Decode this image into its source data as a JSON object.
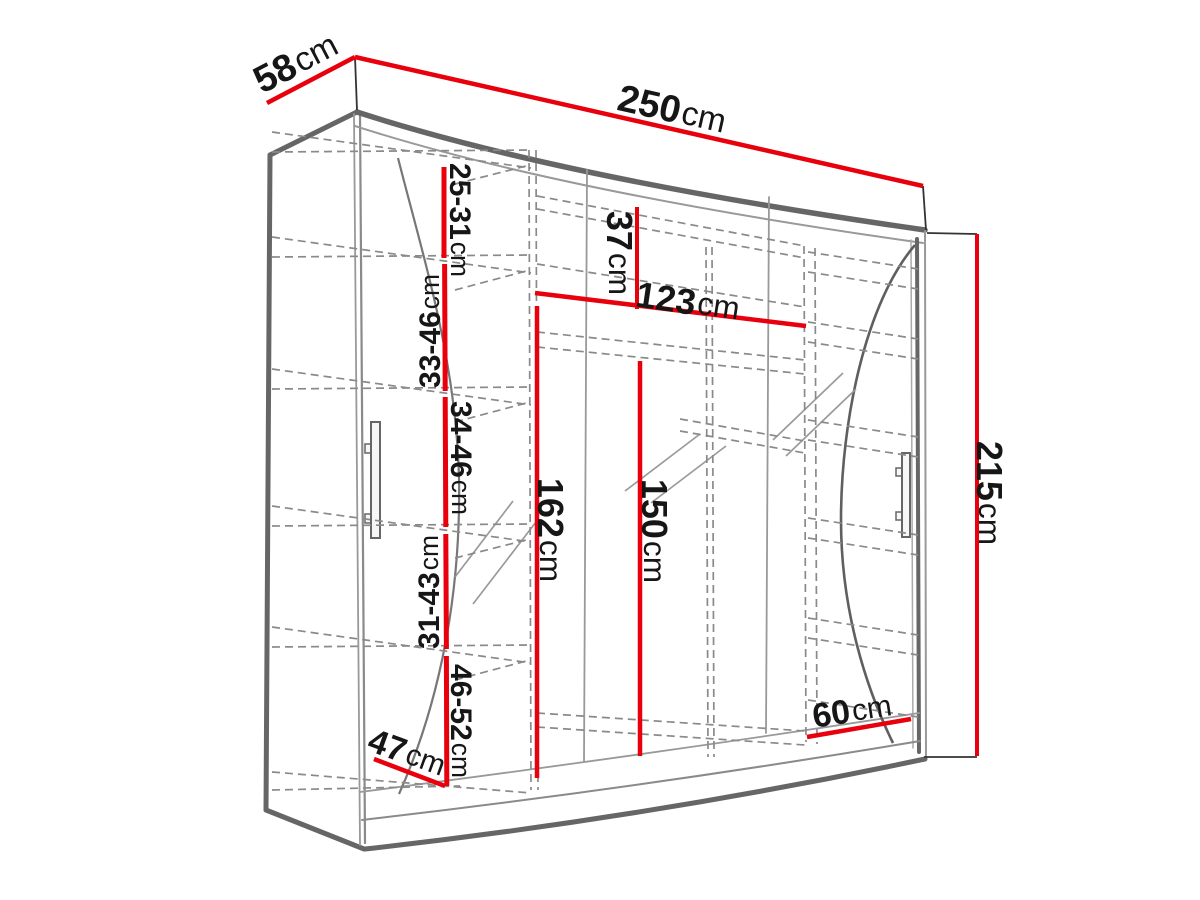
{
  "diagram": {
    "type": "furniture-dimension-drawing",
    "subject": "three-door sliding wardrobe with interior shelves",
    "accent_color": "#e8000d",
    "structure_color": "#666666",
    "dimensions": {
      "depth": {
        "value": "58",
        "unit": "cm"
      },
      "width": {
        "value": "250",
        "unit": "cm"
      },
      "height": {
        "value": "215",
        "unit": "cm"
      },
      "top_compartment_height": {
        "value": "37",
        "unit": "cm"
      },
      "middle_compartment_width": {
        "value": "123",
        "unit": "cm"
      },
      "hanging_height_left": {
        "value": "162",
        "unit": "cm"
      },
      "hanging_height_right": {
        "value": "150",
        "unit": "cm"
      },
      "right_compartment_width": {
        "value": "60",
        "unit": "cm"
      },
      "interior_depth": {
        "value": "47",
        "unit": "cm"
      },
      "shelf_spacing_1": {
        "value": "25-31",
        "unit": "cm"
      },
      "shelf_spacing_2": {
        "value": "33-46",
        "unit": "cm"
      },
      "shelf_spacing_3": {
        "value": "34-46",
        "unit": "cm"
      },
      "shelf_spacing_4": {
        "value": "31-43",
        "unit": "cm"
      },
      "shelf_spacing_5": {
        "value": "46-52",
        "unit": "cm"
      }
    }
  }
}
